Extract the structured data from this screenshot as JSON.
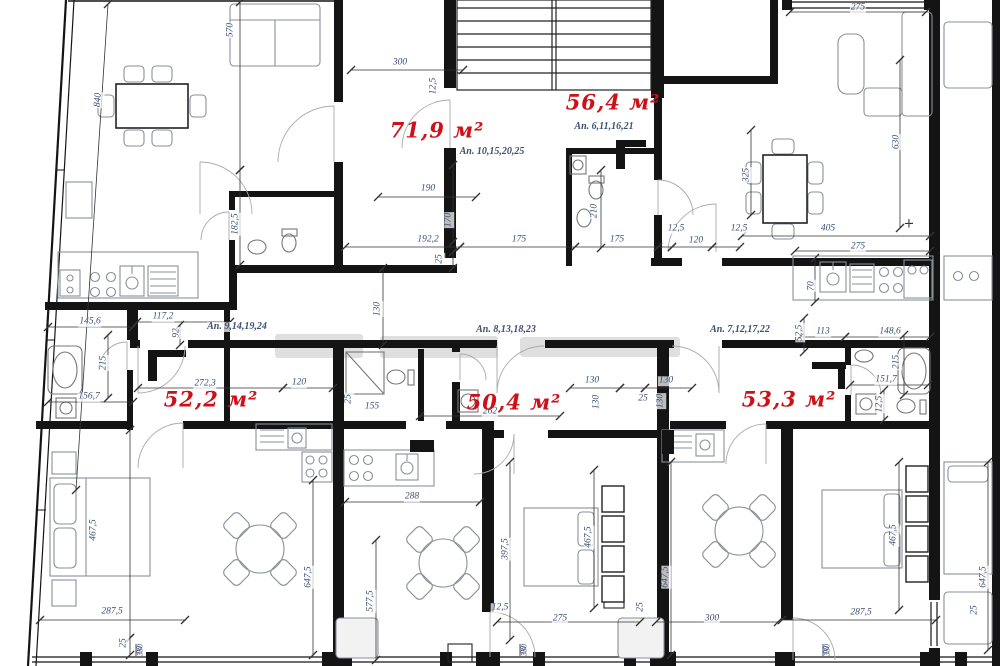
{
  "drawing": {
    "type": "floor-plan",
    "area_unit": "м²",
    "apartments": [
      {
        "area": "71,9 м²",
        "units": "Ап. 10,15,20,25"
      },
      {
        "area": "56,4 м²",
        "units": "Ап. 6,11,16,21"
      },
      {
        "area": "52,2 м²",
        "units": "Ап. 9,14,19,24"
      },
      {
        "area": "50,4 м²",
        "units": "Ап. 8,13,18,23"
      },
      {
        "area": "53,3 м²",
        "units": "Ап. 7,12,17,22"
      }
    ]
  },
  "colors": {
    "area_label": "#cc1118",
    "dim_label": "#3d4f73",
    "wall": "#141414",
    "furniture": "#8a8f98",
    "watermark": "#b9b9b9"
  },
  "labels": {
    "areas": [
      {
        "t": "71,9 м²",
        "x": 437,
        "y": 130
      },
      {
        "t": "56,4 м²",
        "x": 613,
        "y": 102
      },
      {
        "t": "52,2 м²",
        "x": 211,
        "y": 399
      },
      {
        "t": "50,4 м²",
        "x": 514,
        "y": 402
      },
      {
        "t": "53,3 м²",
        "x": 789,
        "y": 399
      }
    ],
    "apartments": [
      {
        "t": "Ап. 10,15,20,25",
        "x": 492,
        "y": 152
      },
      {
        "t": "Ап. 6,11,16,21",
        "x": 604,
        "y": 127
      },
      {
        "t": "Ап. 9,14,19,24",
        "x": 237,
        "y": 327
      },
      {
        "t": "Ап. 8,13,18,23",
        "x": 506,
        "y": 330
      },
      {
        "t": "Ап. 7,12,17,22",
        "x": 740,
        "y": 330
      }
    ],
    "dims": [
      {
        "t": "570",
        "x": 231,
        "y": 30,
        "r": -90
      },
      {
        "t": "840",
        "x": 99,
        "y": 100,
        "r": -86
      },
      {
        "t": "300",
        "x": 400,
        "y": 63
      },
      {
        "t": "12,5",
        "x": 434,
        "y": 86,
        "r": -90
      },
      {
        "t": "275",
        "x": 858,
        "y": 8
      },
      {
        "t": "630",
        "x": 897,
        "y": 142,
        "r": -90
      },
      {
        "t": "190",
        "x": 428,
        "y": 189
      },
      {
        "t": "170",
        "x": 449,
        "y": 220,
        "r": -90
      },
      {
        "t": "182,5",
        "x": 236,
        "y": 224,
        "r": -90
      },
      {
        "t": "210",
        "x": 595,
        "y": 211,
        "r": -90
      },
      {
        "t": "325",
        "x": 747,
        "y": 175,
        "r": -90
      },
      {
        "t": "192,2",
        "x": 428,
        "y": 240
      },
      {
        "t": "175",
        "x": 519,
        "y": 240
      },
      {
        "t": "175",
        "x": 617,
        "y": 240
      },
      {
        "t": "12,5",
        "x": 676,
        "y": 229
      },
      {
        "t": "120",
        "x": 696,
        "y": 241
      },
      {
        "t": "12,5",
        "x": 739,
        "y": 229
      },
      {
        "t": "405",
        "x": 828,
        "y": 229
      },
      {
        "t": "275",
        "x": 858,
        "y": 247
      },
      {
        "t": "25",
        "x": 440,
        "y": 259,
        "r": -90
      },
      {
        "t": "70",
        "x": 812,
        "y": 286,
        "r": -90
      },
      {
        "t": "130",
        "x": 378,
        "y": 309,
        "r": -90
      },
      {
        "t": "145,6",
        "x": 90,
        "y": 322
      },
      {
        "t": "117,2",
        "x": 163,
        "y": 317
      },
      {
        "t": "92",
        "x": 177,
        "y": 333,
        "r": -90
      },
      {
        "t": "113",
        "x": 823,
        "y": 332
      },
      {
        "t": "148,6",
        "x": 890,
        "y": 332
      },
      {
        "t": "52,5",
        "x": 800,
        "y": 333,
        "r": -90
      },
      {
        "t": "215",
        "x": 104,
        "y": 363,
        "r": -90
      },
      {
        "t": "215",
        "x": 897,
        "y": 362,
        "r": -90
      },
      {
        "t": "156,7",
        "x": 89,
        "y": 397
      },
      {
        "t": "151,7",
        "x": 886,
        "y": 380
      },
      {
        "t": "12,5",
        "x": 880,
        "y": 404,
        "r": -90
      },
      {
        "t": "272,3",
        "x": 205,
        "y": 384
      },
      {
        "t": "120",
        "x": 299,
        "y": 383
      },
      {
        "t": "25",
        "x": 349,
        "y": 399,
        "r": -90
      },
      {
        "t": "155",
        "x": 372,
        "y": 407
      },
      {
        "t": "130",
        "x": 592,
        "y": 381
      },
      {
        "t": "130",
        "x": 666,
        "y": 381
      },
      {
        "t": "130",
        "x": 597,
        "y": 402,
        "r": -90
      },
      {
        "t": "25",
        "x": 643,
        "y": 399
      },
      {
        "t": "130",
        "x": 661,
        "y": 401,
        "r": -90
      },
      {
        "t": "262",
        "x": 490,
        "y": 412
      },
      {
        "t": "288",
        "x": 412,
        "y": 497
      },
      {
        "t": "467,5",
        "x": 94,
        "y": 530,
        "r": -90
      },
      {
        "t": "647,5",
        "x": 309,
        "y": 577,
        "r": -90
      },
      {
        "t": "577,5",
        "x": 371,
        "y": 601,
        "r": -90
      },
      {
        "t": "397,5",
        "x": 506,
        "y": 549,
        "r": -90
      },
      {
        "t": "467,5",
        "x": 589,
        "y": 537,
        "r": -90
      },
      {
        "t": "647,5",
        "x": 666,
        "y": 577,
        "r": -90
      },
      {
        "t": "467,5",
        "x": 894,
        "y": 535,
        "r": -90
      },
      {
        "t": "647,5",
        "x": 984,
        "y": 577,
        "r": -90
      },
      {
        "t": "287,5",
        "x": 112,
        "y": 612
      },
      {
        "t": "25",
        "x": 124,
        "y": 643,
        "r": -90
      },
      {
        "t": "12,5",
        "x": 500,
        "y": 608
      },
      {
        "t": "275",
        "x": 560,
        "y": 619
      },
      {
        "t": "25",
        "x": 641,
        "y": 607,
        "r": -90
      },
      {
        "t": "300",
        "x": 712,
        "y": 619
      },
      {
        "t": "287,5",
        "x": 861,
        "y": 613
      },
      {
        "t": "25",
        "x": 975,
        "y": 610,
        "r": -90
      }
    ],
    "window_marks": [
      {
        "top": "90",
        "bottom": "330",
        "x": 140,
        "y": 650
      },
      {
        "top": "90",
        "bottom": "330",
        "x": 524,
        "y": 650
      },
      {
        "top": "90",
        "bottom": "330",
        "x": 827,
        "y": 650
      }
    ],
    "plus_marks": [
      {
        "t": "+",
        "x": 909,
        "y": 224
      }
    ]
  }
}
